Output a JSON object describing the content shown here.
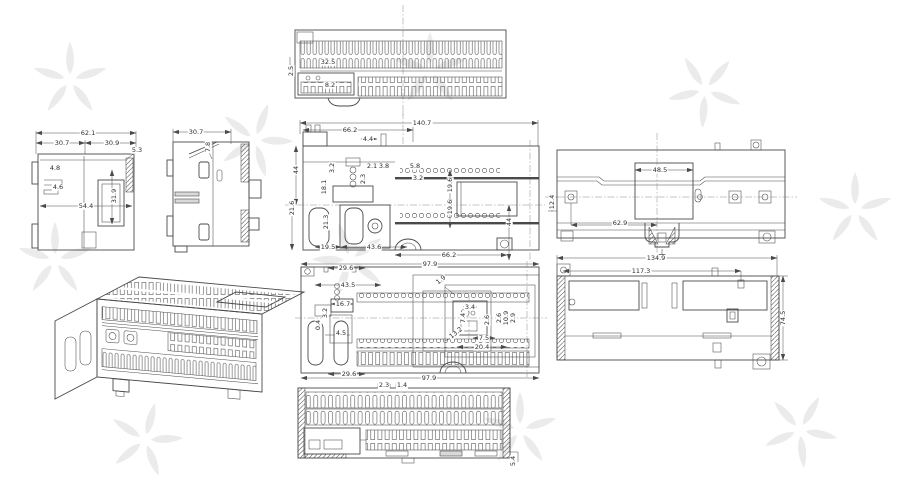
{
  "colors": {
    "ink": "#4a4a4a",
    "background": "#ffffff",
    "watermark": "#ebebeb"
  },
  "views": {
    "top": {
      "d1": "32.5",
      "d2": "8.2",
      "d3": "2.5"
    },
    "left": {
      "d1": "62.1",
      "d2": "30.7",
      "d3": "30.9",
      "d4": "5.3",
      "d5": "4.8",
      "d6": "4.6",
      "d7": "54.4",
      "d8": "31.9"
    },
    "side": {
      "d1": "30.7",
      "d2": "7.8"
    },
    "center": {
      "d1": "140.7",
      "d2": "66.2",
      "d3": "4.4",
      "d4": "44",
      "d5": "3.2",
      "d6": "18.1",
      "d7": "2.1",
      "d8": "3.8",
      "d9": "2.3",
      "d10": "5.8",
      "d11": "3.2",
      "d12": "21.6",
      "d13": "21.3",
      "d14": "19.6",
      "d15": "19.6",
      "d16": "44",
      "d17": "66.2",
      "d18": "19.5",
      "d19": "43.6"
    },
    "rear": {
      "d1": "48.5",
      "d2": "62.9",
      "d3": "12.4"
    },
    "front": {
      "d1": "29.6",
      "d2": "43.5",
      "d3": "16.7",
      "d4": "3.2",
      "d5": "0.4",
      "d6": "4.5",
      "d7": "29.6",
      "d8": "97.9",
      "d9": "97.9",
      "d10": "1.9",
      "d11": "3.4",
      "d12": "7.4",
      "d13": "2.6",
      "d14": "13.2",
      "d15": "7.5",
      "d16": "20.4",
      "d17": "2.6",
      "d18": "10.9",
      "d19": "2.9"
    },
    "tray": {
      "d1": "134.9",
      "d2": "117.3",
      "d3": "74.5"
    },
    "bottom": {
      "d1": "2.3",
      "d2": "1.4",
      "d3": "5.4"
    }
  }
}
